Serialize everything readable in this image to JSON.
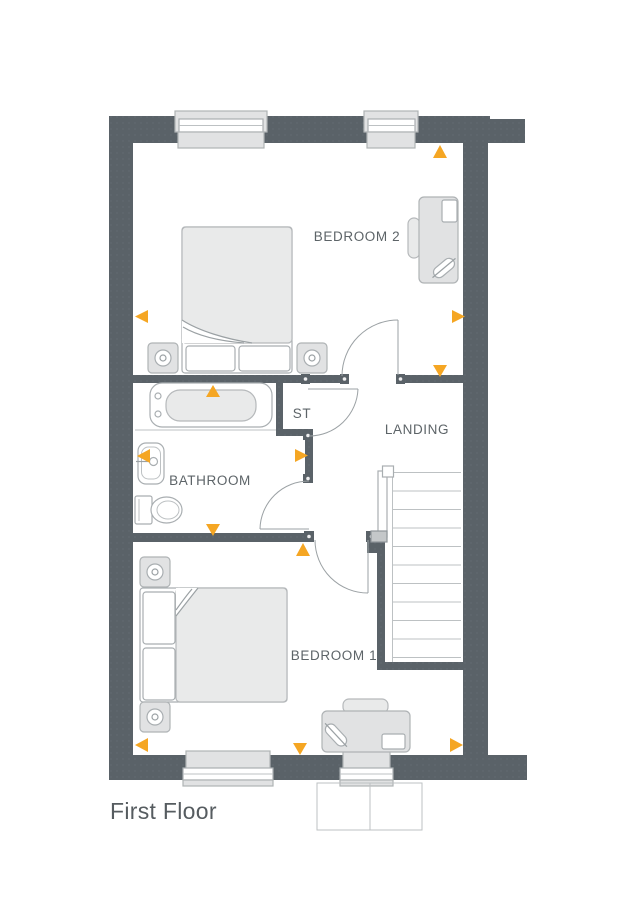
{
  "floor_label": "First Floor",
  "rooms": [
    {
      "id": "bedroom-2",
      "label": "BEDROOM 2",
      "fixtures": [
        "double-bed",
        "bedside-table",
        "bedside-table",
        "desk",
        "desk-chair",
        "window",
        "window",
        "door"
      ]
    },
    {
      "id": "storage",
      "label": "ST",
      "fixtures": [
        "door"
      ]
    },
    {
      "id": "landing",
      "label": "LANDING",
      "fixtures": [
        "staircase",
        "handrail"
      ]
    },
    {
      "id": "bathroom",
      "label": "BATHROOM",
      "fixtures": [
        "bath",
        "basin",
        "toilet",
        "door"
      ]
    },
    {
      "id": "bedroom-1",
      "label": "BEDROOM 1",
      "fixtures": [
        "double-bed",
        "bedside-table",
        "bedside-table",
        "desk",
        "desk-chair",
        "window",
        "window",
        "door"
      ]
    }
  ],
  "markers": {
    "shape": "triangle",
    "color": "#F5A623",
    "count": 12,
    "items": [
      {
        "direction": "up",
        "location": "bedroom-2-top"
      },
      {
        "direction": "left",
        "location": "bedroom-2-left"
      },
      {
        "direction": "right",
        "location": "bedroom-2-right"
      },
      {
        "direction": "down",
        "location": "landing-top"
      },
      {
        "direction": "up",
        "location": "bath"
      },
      {
        "direction": "left",
        "location": "bathroom-left"
      },
      {
        "direction": "right",
        "location": "bathroom-door"
      },
      {
        "direction": "down",
        "location": "bathroom-bottom"
      },
      {
        "direction": "up",
        "location": "bedroom-1-top"
      },
      {
        "direction": "left",
        "location": "bedroom-1-left"
      },
      {
        "direction": "down",
        "location": "bedroom-1-bottom"
      },
      {
        "direction": "right",
        "location": "bedroom-1-right"
      }
    ]
  },
  "colors": {
    "wall": "#5A6268",
    "furniture_fill": "#E1E2E3",
    "furniture_fill_light": "#E9EAEA",
    "outline": "#A9AEB1",
    "thin_line": "#BDC1C3",
    "marker": "#F5A623",
    "label_text": "#5D6468",
    "title_text": "#565C60",
    "background": "#FFFFFF"
  }
}
